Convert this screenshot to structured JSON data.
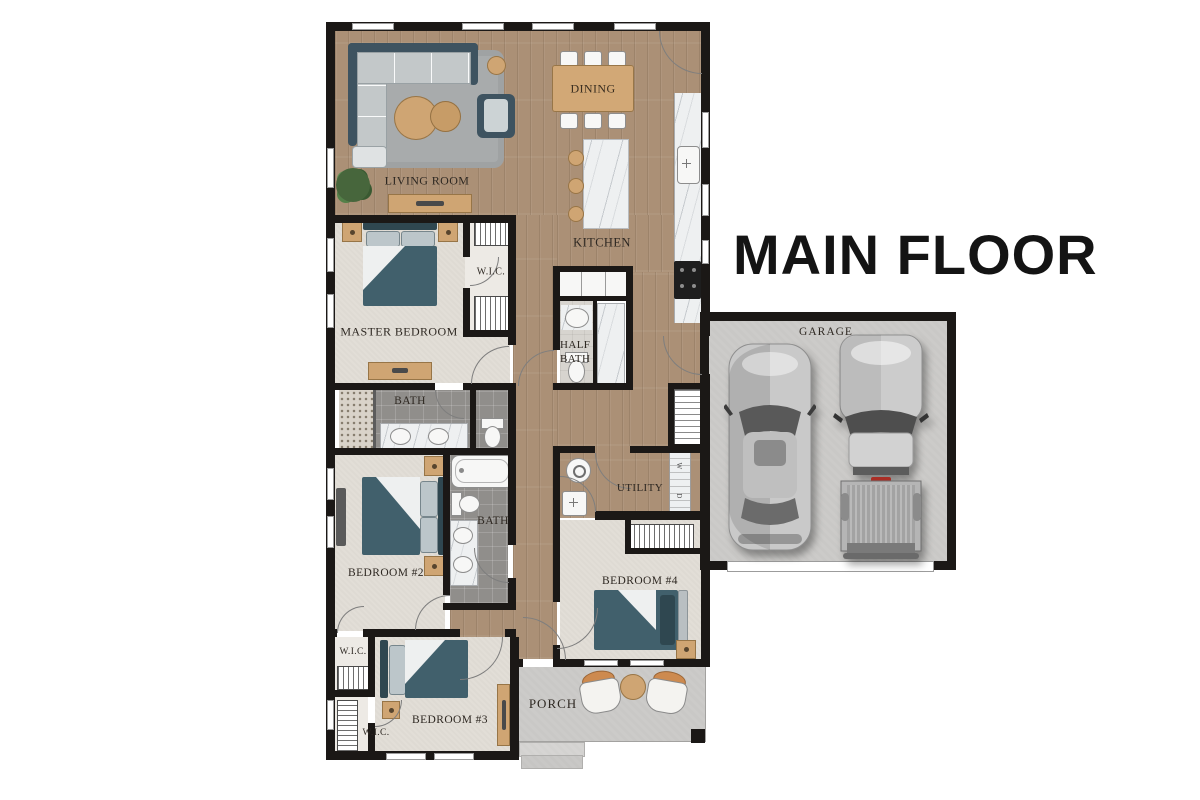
{
  "title": "MAIN FLOOR",
  "labels": {
    "living_room": "LIVING ROOM",
    "dining": "DINING",
    "kitchen": "KITCHEN",
    "master_bedroom": "MASTER BEDROOM",
    "master_wic": "W.I.C.",
    "half_bath": "HALF BATH",
    "master_bath": "BATH",
    "bath_2": "BATH",
    "bedroom_2": "BEDROOM #2",
    "utility": "UTILITY",
    "bedroom_4": "BEDROOM #4",
    "bedroom_3": "BEDROOM #3",
    "wic_upper": "W.I.C.",
    "wic_lower": "W.I.C.",
    "porch": "PORCH",
    "garage": "GARAGE"
  },
  "utility_appliances": {
    "washer": "W",
    "dryer": "D"
  },
  "vehicles": {
    "left": "sedan-top-view",
    "right": "pickup-truck-top-view"
  },
  "colors": {
    "wall": "#1b1816",
    "wood_floor": "#ab9076",
    "carpet": "#e2ded7",
    "dark_tile": "#908e8b",
    "concrete": "#c9c8c6",
    "furniture_teal": "#41606c",
    "furniture_wood": "#cfa573",
    "marble": "#eef0f1",
    "rug_gray": "#a8abac",
    "accent_orange": "#cd8a4f",
    "title_black": "#141414"
  }
}
